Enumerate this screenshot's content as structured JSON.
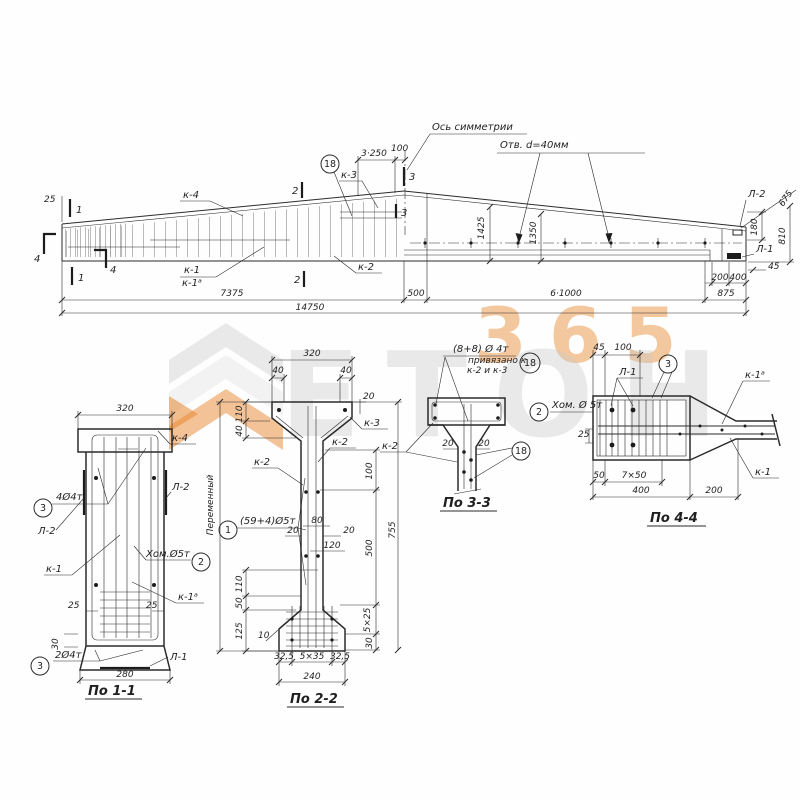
{
  "watermark": {
    "brand": "ЕТОН",
    "number": "365"
  },
  "colors": {
    "ink": "#2b2b2b",
    "accent_orange": "#e8872f",
    "watermark_gray": "#c8c8c8"
  },
  "elevation": {
    "axis_label": "Ось симметрии",
    "holes_label": "Отв. d=40мм",
    "dims": {
      "top_spacing": "3·250",
      "top_100": "100",
      "left_25": "25",
      "span_left": "7375",
      "span_500": "500",
      "span_holes": "6·1000",
      "span_875": "875",
      "total": "14750",
      "end_200": "200",
      "end_400": "400",
      "end_45": "45",
      "end_180": "180",
      "end_675": "675",
      "end_810": "810",
      "h_1425": "1425",
      "h_1350": "1350"
    },
    "marks": {
      "s1": "1",
      "s2": "2",
      "s3": "3",
      "s4": "4"
    },
    "callouts": {
      "k1": "к-1",
      "k1a": "к-1ᵃ",
      "k2": "к-2",
      "k3": "к-3",
      "k4": "к-4",
      "n18": "18",
      "l1": "Л-1",
      "l2": "Л-2"
    }
  },
  "section_1_1": {
    "title": "По 1-1",
    "dims": {
      "w_top": "320",
      "w_bot": "280",
      "cover": "25",
      "s30": "30"
    },
    "callouts": {
      "k4": "к-4",
      "l2": "Л-2",
      "l1": "Л-1",
      "k1": "к-1",
      "k1a": "к-1ᵃ",
      "n3": "3",
      "n2": "2",
      "bars4": "4Ø4т",
      "bars2": "2Ø4т",
      "stirrup": "Хом.Ø5т"
    }
  },
  "section_2_2": {
    "title": "По 2-2",
    "dims": {
      "w_top": "320",
      "f40": "40",
      "f20": "20",
      "f110": "110",
      "r100": "100",
      "r500": "500",
      "r755": "755",
      "r5x25": "5×25",
      "r30": "30",
      "l110": "110",
      "l50": "50",
      "l125": "125",
      "l10": "10",
      "w80": "80",
      "w20": "20",
      "w120": "120",
      "b325": "32,5",
      "b5x35": "5×35",
      "b240": "240",
      "variable": "Переменный"
    },
    "callouts": {
      "k2": "к-2",
      "k3": "к-3",
      "n1": "1",
      "bars": "(59+4)Ø5т"
    }
  },
  "section_3_3": {
    "title": "По 3-3",
    "note1": "(8+8) Ø 4т",
    "note2": "привязано к",
    "note3": "к-2 и к-3",
    "n18": "18",
    "k2": "к-2",
    "d20": "20"
  },
  "section_4_4": {
    "title": "По 4-4",
    "dims": {
      "t45": "45",
      "t100": "100",
      "l25": "25",
      "b50": "50",
      "b7x50": "7×50",
      "b400": "400",
      "b200": "200"
    },
    "callouts": {
      "l1": "Л-1",
      "n3": "3",
      "n2": "2",
      "stirrup": "Хом. Ø 5т",
      "k1a": "к-1ᵃ",
      "k1": "к-1",
      "n18": "18"
    }
  }
}
